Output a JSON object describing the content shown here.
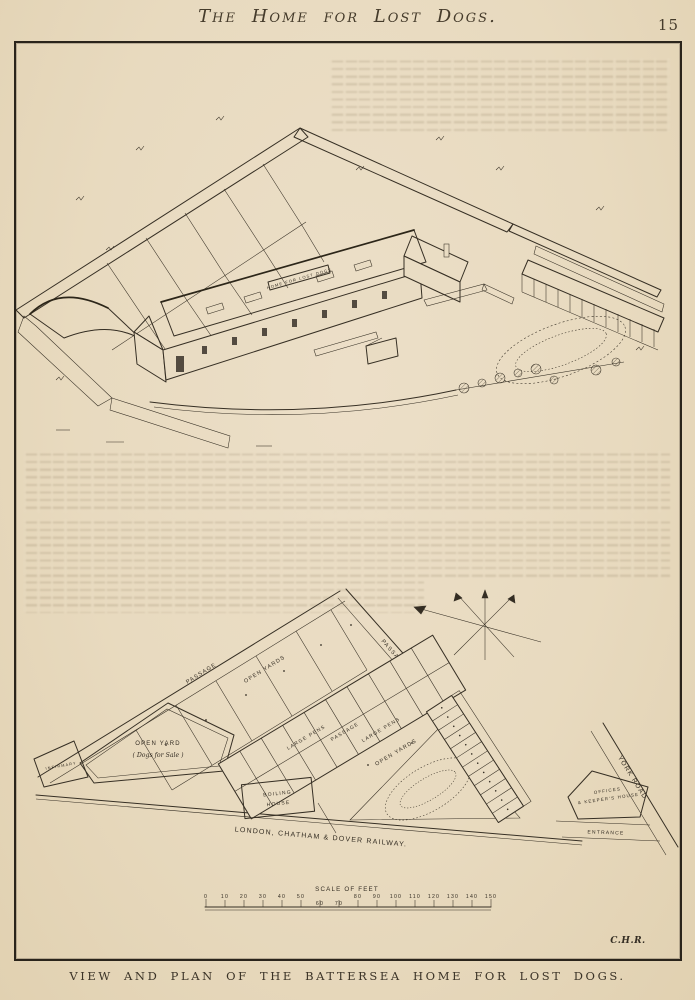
{
  "page": {
    "title": "The Home for Lost Dogs.",
    "page_number": "15",
    "caption": "VIEW AND PLAN OF THE BATTERSEA HOME FOR LOST DOGS.",
    "signature": "C.H.R."
  },
  "view": {
    "roof_sign": "HOME FOR LOST DOGS"
  },
  "plan": {
    "labels": {
      "passage_left": "PASSAGE",
      "passage_right": "PASSAGE",
      "open_yards_left": "OPEN YARDS",
      "open_yards_right": "OPEN YARDS",
      "large_pens_upper": "LARGE PENS",
      "central_passage": "PASSAGE",
      "large_pens_lower": "LARGE PENS",
      "open_yard_title": "OPEN YARD",
      "open_yard_subtitle": "( Dogs for Sale )",
      "infirmary": "INFIRMARY",
      "boiling_house_line1": "BOILING",
      "boiling_house_line2": "HOUSE",
      "offices_line1": "OFFICES",
      "offices_line2": "& KEEPER'S HOUSE",
      "entrance": "ENTRANCE",
      "york_road": "YORK ROAD",
      "railway": "LONDON, CHATHAM & DOVER RAILWAY."
    },
    "scale": {
      "title": "SCALE OF FEET",
      "ticks": [
        "0",
        "10",
        "20",
        "30",
        "40",
        "50",
        "60",
        "70",
        "80",
        "90",
        "100",
        "110",
        "120",
        "130",
        "140",
        "150"
      ]
    }
  },
  "icons": {
    "compass_rose": "star-with-long-north-arrow"
  },
  "colors": {
    "paper": "#e9dcc3",
    "ink": "#342d23"
  }
}
